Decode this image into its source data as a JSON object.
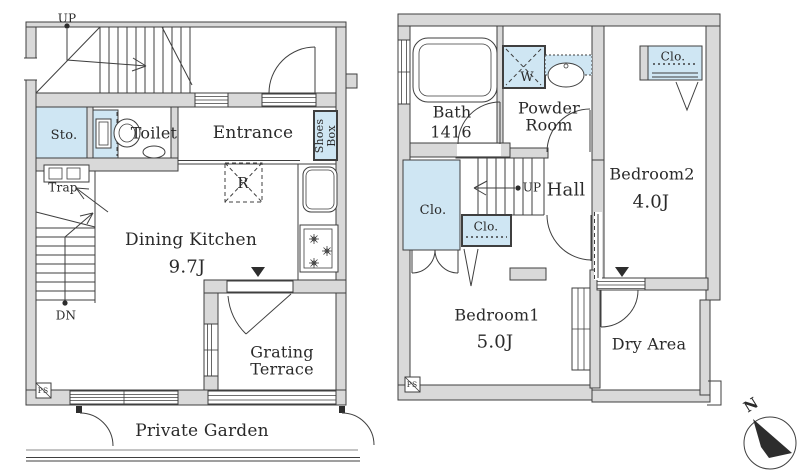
{
  "colors": {
    "wall": "#d9d9d9",
    "closet": "#cfe6f3",
    "line": "#3f3f3f",
    "text": "#2a2a2a",
    "marker": "#2d2d2d"
  },
  "floor1": {
    "labels": {
      "up": "UP",
      "storage": "Sto.",
      "toilet": "Toilet",
      "entrance": "Entrance",
      "shoes_box": "Shoes Box",
      "trap": "Trap",
      "refrigerator": "R",
      "dining_kitchen": "Dining Kitchen",
      "dining_kitchen_size": "9.7J",
      "down": "DN",
      "pipe_space": "PS",
      "grating_terrace": "Grating Terrace",
      "private_garden": "Private Garden"
    }
  },
  "floor2": {
    "labels": {
      "bath": "Bath",
      "bath_size": "1416",
      "washer": "W",
      "powder_room": "Powder Room",
      "closet_bedroom2": "Clo.",
      "closet_hall_large": "Clo.",
      "closet_hall_small": "Clo.",
      "hall": "Hall",
      "up": "UP",
      "bedroom2": "Bedroom2",
      "bedroom2_size": "4.0J",
      "bedroom1": "Bedroom1",
      "bedroom1_size": "5.0J",
      "dry_area": "Dry Area",
      "pipe_space": "PS"
    }
  },
  "compass": {
    "north_label": "N"
  }
}
